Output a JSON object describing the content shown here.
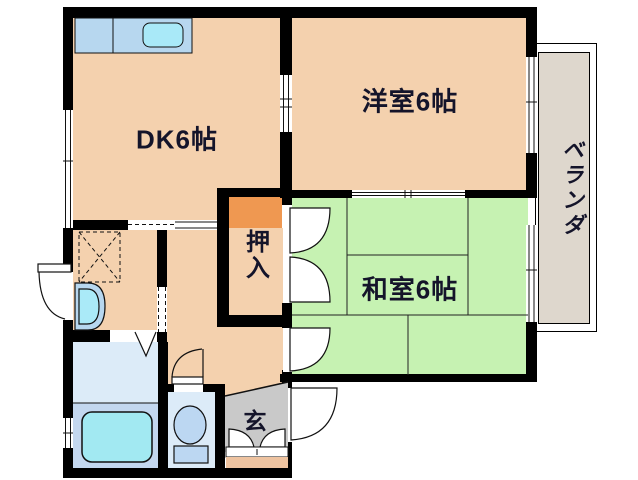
{
  "rooms": {
    "dining_kitchen": {
      "label": "DK6帖",
      "color": "#F4D1AE"
    },
    "western_room": {
      "label": "洋室6帖",
      "color": "#F4D1AE"
    },
    "japanese_room": {
      "label": "和室6帖",
      "color": "#C6F2B2"
    },
    "closet": {
      "label": "押入",
      "color": "#EF9851"
    },
    "veranda": {
      "label": "ベランダ",
      "color": "#DED7CD"
    },
    "entrance": {
      "label": "玄",
      "color": "#C9C9C9",
      "step_color": "#EEC3A0"
    },
    "hallway": {
      "color": "#F4D1AE"
    },
    "bathroom": {
      "upper_color": "#DCEBF8",
      "lower_color": "#C3D7EF"
    },
    "toilet_room": {
      "color": "#DCEBF8"
    }
  },
  "fixtures": {
    "kitchen_counter_color": "#B7D7EF",
    "kitchen_sink_color": "#A9E9F8",
    "bathtub_color": "#A2E9F2",
    "toilet_color": "#BCD7F2",
    "washbasin_outer_color": "#B7D7EF",
    "washbasin_inner_color": "#AAEAF8"
  },
  "wall_color": "#000000",
  "text_color": "#14142A"
}
